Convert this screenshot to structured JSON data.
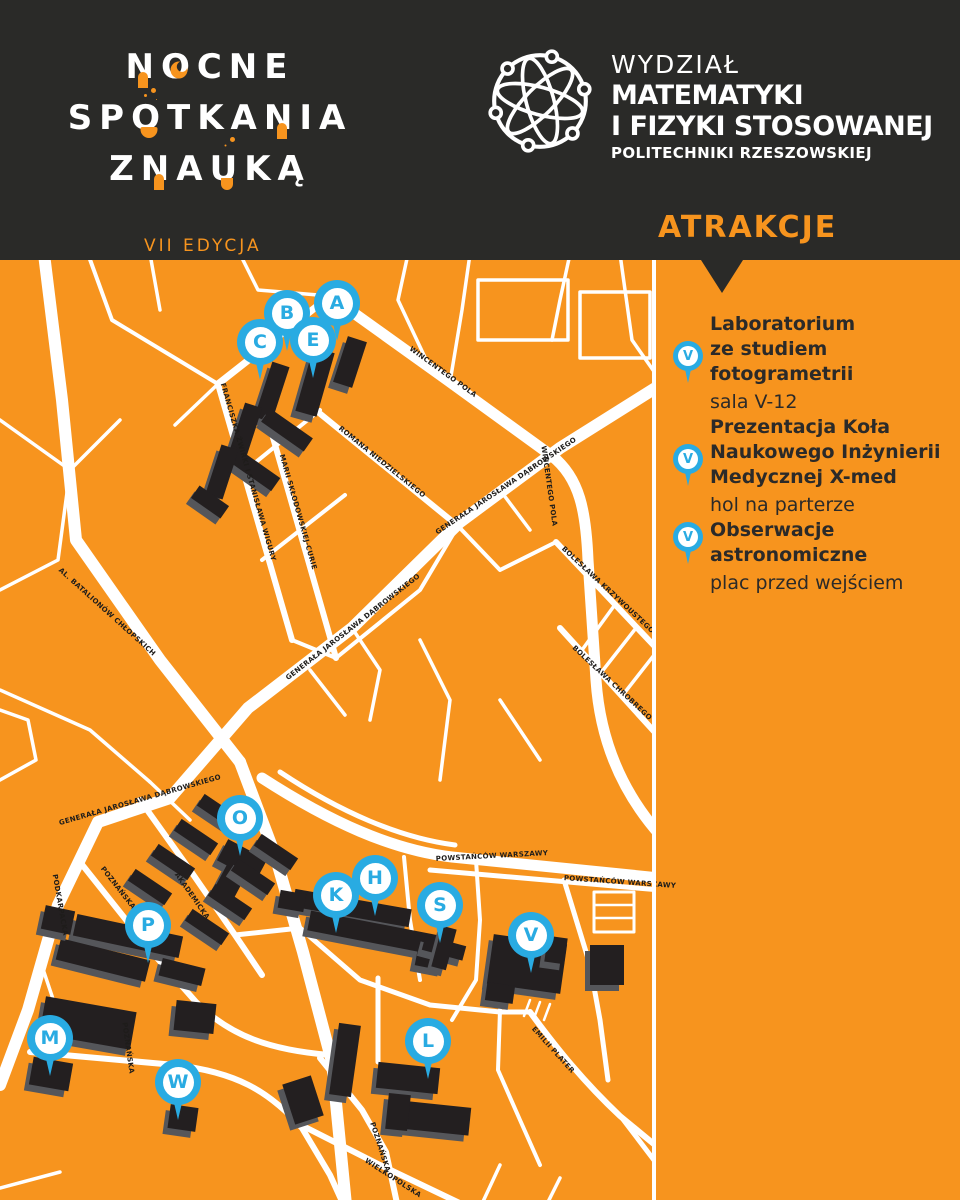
{
  "colors": {
    "orange": "#F7941E",
    "dark_header": "#2A2A28",
    "pin_blue": "#29ABE2",
    "building_black": "#231F20",
    "building_shadow": "#55565A",
    "street_white": "#FFFFFF",
    "text_dark": "#2B2A29"
  },
  "header": {
    "logo": {
      "line1": [
        {
          "t": "N",
          "acc": "door"
        },
        {
          "t": "O",
          "acc": "moon"
        },
        {
          "t": "CNE"
        }
      ],
      "line2": [
        {
          "t": "SP"
        },
        {
          "t": "O",
          "acc": "flask"
        },
        {
          "t": "TKA"
        },
        {
          "t": "N",
          "acc": "door"
        },
        {
          "t": "IA"
        }
      ],
      "line3": [
        {
          "t": "Z "
        },
        {
          "t": "N",
          "acc": "door"
        },
        {
          "t": "A"
        },
        {
          "t": "U",
          "acc": "tube"
        },
        {
          "t": "KĄ"
        }
      ],
      "edition": "VII EDYCJA"
    },
    "faculty": {
      "l1": "WYDZIAŁ",
      "l2": "MATEMATYKI",
      "l3": "I FIZYKI STOSOWANEJ",
      "l4": "POLITECHNIKI RZESZOWSKIEJ"
    },
    "section_title": "ATRAKCJE"
  },
  "map": {
    "pins": [
      {
        "letter": "A",
        "x": 337,
        "y": 303
      },
      {
        "letter": "B",
        "x": 287,
        "y": 313
      },
      {
        "letter": "C",
        "x": 260,
        "y": 342
      },
      {
        "letter": "E",
        "x": 313,
        "y": 340
      },
      {
        "letter": "O",
        "x": 240,
        "y": 818
      },
      {
        "letter": "H",
        "x": 375,
        "y": 878
      },
      {
        "letter": "K",
        "x": 336,
        "y": 895
      },
      {
        "letter": "P",
        "x": 148,
        "y": 925
      },
      {
        "letter": "S",
        "x": 440,
        "y": 905
      },
      {
        "letter": "V",
        "x": 531,
        "y": 935
      },
      {
        "letter": "M",
        "x": 50,
        "y": 1038
      },
      {
        "letter": "L",
        "x": 428,
        "y": 1041
      },
      {
        "letter": "W",
        "x": 178,
        "y": 1082
      }
    ],
    "street_labels": [
      {
        "text": "WINCENTEGO POLA",
        "x": 443,
        "y": 372,
        "rot": 36
      },
      {
        "text": "FRANCISZKA ŻWIRKI I STANISŁAWA WIGURY",
        "x": 248,
        "y": 472,
        "rot": 74
      },
      {
        "text": "MARII SKŁODOWSKIEJ-CURIE",
        "x": 298,
        "y": 512,
        "rot": 74
      },
      {
        "text": "ROMANA NIEDZIELSKIEGO",
        "x": 382,
        "y": 462,
        "rot": 39
      },
      {
        "text": "GENERAŁA JAROSŁAWA DĄBROWSKIEGO",
        "x": 506,
        "y": 486,
        "rot": -34
      },
      {
        "text": "GENERAŁA JAROSŁAWA DĄBROWSKIEGO",
        "x": 353,
        "y": 627,
        "rot": -38
      },
      {
        "text": "AL. BATALIONÓW CHŁOPSKICH",
        "x": 107,
        "y": 612,
        "rot": 42
      },
      {
        "text": "WINCENTEGO POLA",
        "x": 549,
        "y": 486,
        "rot": 82
      },
      {
        "text": "BOLESŁAWA KRZYWOUSTEGO",
        "x": 608,
        "y": 590,
        "rot": 43
      },
      {
        "text": "BOLESŁAWA CHROBREGO",
        "x": 612,
        "y": 683,
        "rot": 43
      },
      {
        "text": "GENERAŁA JAROSŁAWA DĄBROWSKIEGO",
        "x": 140,
        "y": 800,
        "rot": -16
      },
      {
        "text": "PODKARPACKA",
        "x": 60,
        "y": 905,
        "rot": 80
      },
      {
        "text": "POZNAŃSKA",
        "x": 118,
        "y": 888,
        "rot": 52
      },
      {
        "text": "AKADEMICKA",
        "x": 192,
        "y": 896,
        "rot": 55
      },
      {
        "text": "POWSTAŃCÓW WARSZAWY",
        "x": 492,
        "y": 856,
        "rot": -3
      },
      {
        "text": "POWSTAŃCÓW WARSZAWY",
        "x": 620,
        "y": 882,
        "rot": 4
      },
      {
        "text": "POZNAŃSKA",
        "x": 380,
        "y": 1147,
        "rot": 72
      },
      {
        "text": "WIELKOPOLSKA",
        "x": 393,
        "y": 1178,
        "rot": 33
      },
      {
        "text": "POZNAŃSKA",
        "x": 128,
        "y": 1048,
        "rot": 82
      },
      {
        "text": "EMILII PLATER",
        "x": 553,
        "y": 1050,
        "rot": 48
      }
    ]
  },
  "sidebar": {
    "items": [
      {
        "pin": "V",
        "title_lines": [
          "Laboratorium",
          "ze studiem",
          "fotogrametrii"
        ],
        "subtitle": "sala V-12"
      },
      {
        "pin": "V",
        "title_lines": [
          "Prezentacja Koła",
          "Naukowego Inżynierii",
          "Medycznej X-med"
        ],
        "subtitle": "hol na parterze"
      },
      {
        "pin": "V",
        "title_lines": [
          "Obserwacje",
          "astronomiczne"
        ],
        "subtitle": "plac przed wejściem"
      }
    ]
  }
}
